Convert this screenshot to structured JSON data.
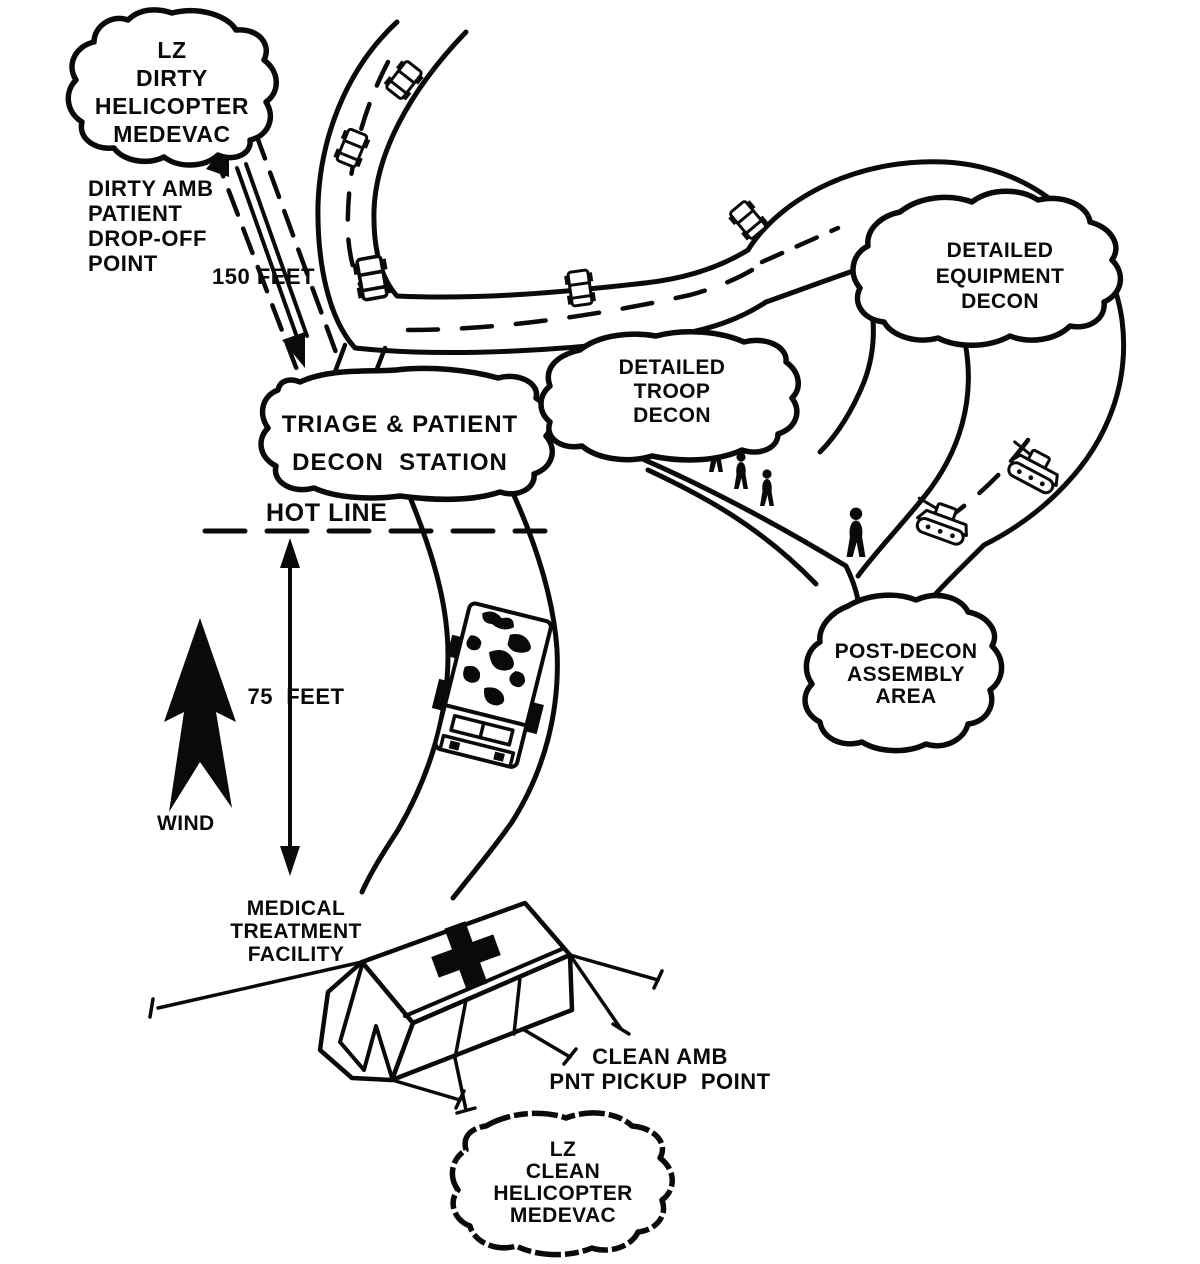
{
  "diagram": {
    "clouds": {
      "lz_dirty": {
        "lines": [
          "LZ",
          "DIRTY",
          "HELICOPTER",
          "MEDEVAC"
        ]
      },
      "triage": {
        "lines": [
          "TRIAGE & PATIENT",
          "DECON  STATION"
        ]
      },
      "troop": {
        "lines": [
          "DETAILED",
          "TROOP",
          "DECON"
        ]
      },
      "equipment": {
        "lines": [
          "DETAILED",
          "EQUIPMENT",
          "DECON"
        ]
      },
      "post_decon": {
        "lines": [
          "POST-DECON",
          "ASSEMBLY",
          "AREA"
        ]
      },
      "lz_clean": {
        "lines": [
          "LZ",
          "CLEAN",
          "HELICOPTER",
          "MEDEVAC"
        ]
      }
    },
    "labels": {
      "dirty_amb": {
        "lines": [
          "DIRTY AMB",
          "PATIENT",
          "DROP-OFF",
          "POINT"
        ]
      },
      "distance_150": "150 FEET",
      "hot_line": "HOT LINE",
      "distance_75": "75  FEET",
      "wind": "WIND",
      "mtf": {
        "lines": [
          "MEDICAL",
          "TREATMENT",
          "FACILITY"
        ]
      },
      "clean_amb": {
        "lines": [
          "CLEAN AMB",
          "PNT PICKUP  POINT"
        ]
      }
    },
    "colors": {
      "ink": "#0a0a0a",
      "paper": "#ffffff"
    }
  }
}
